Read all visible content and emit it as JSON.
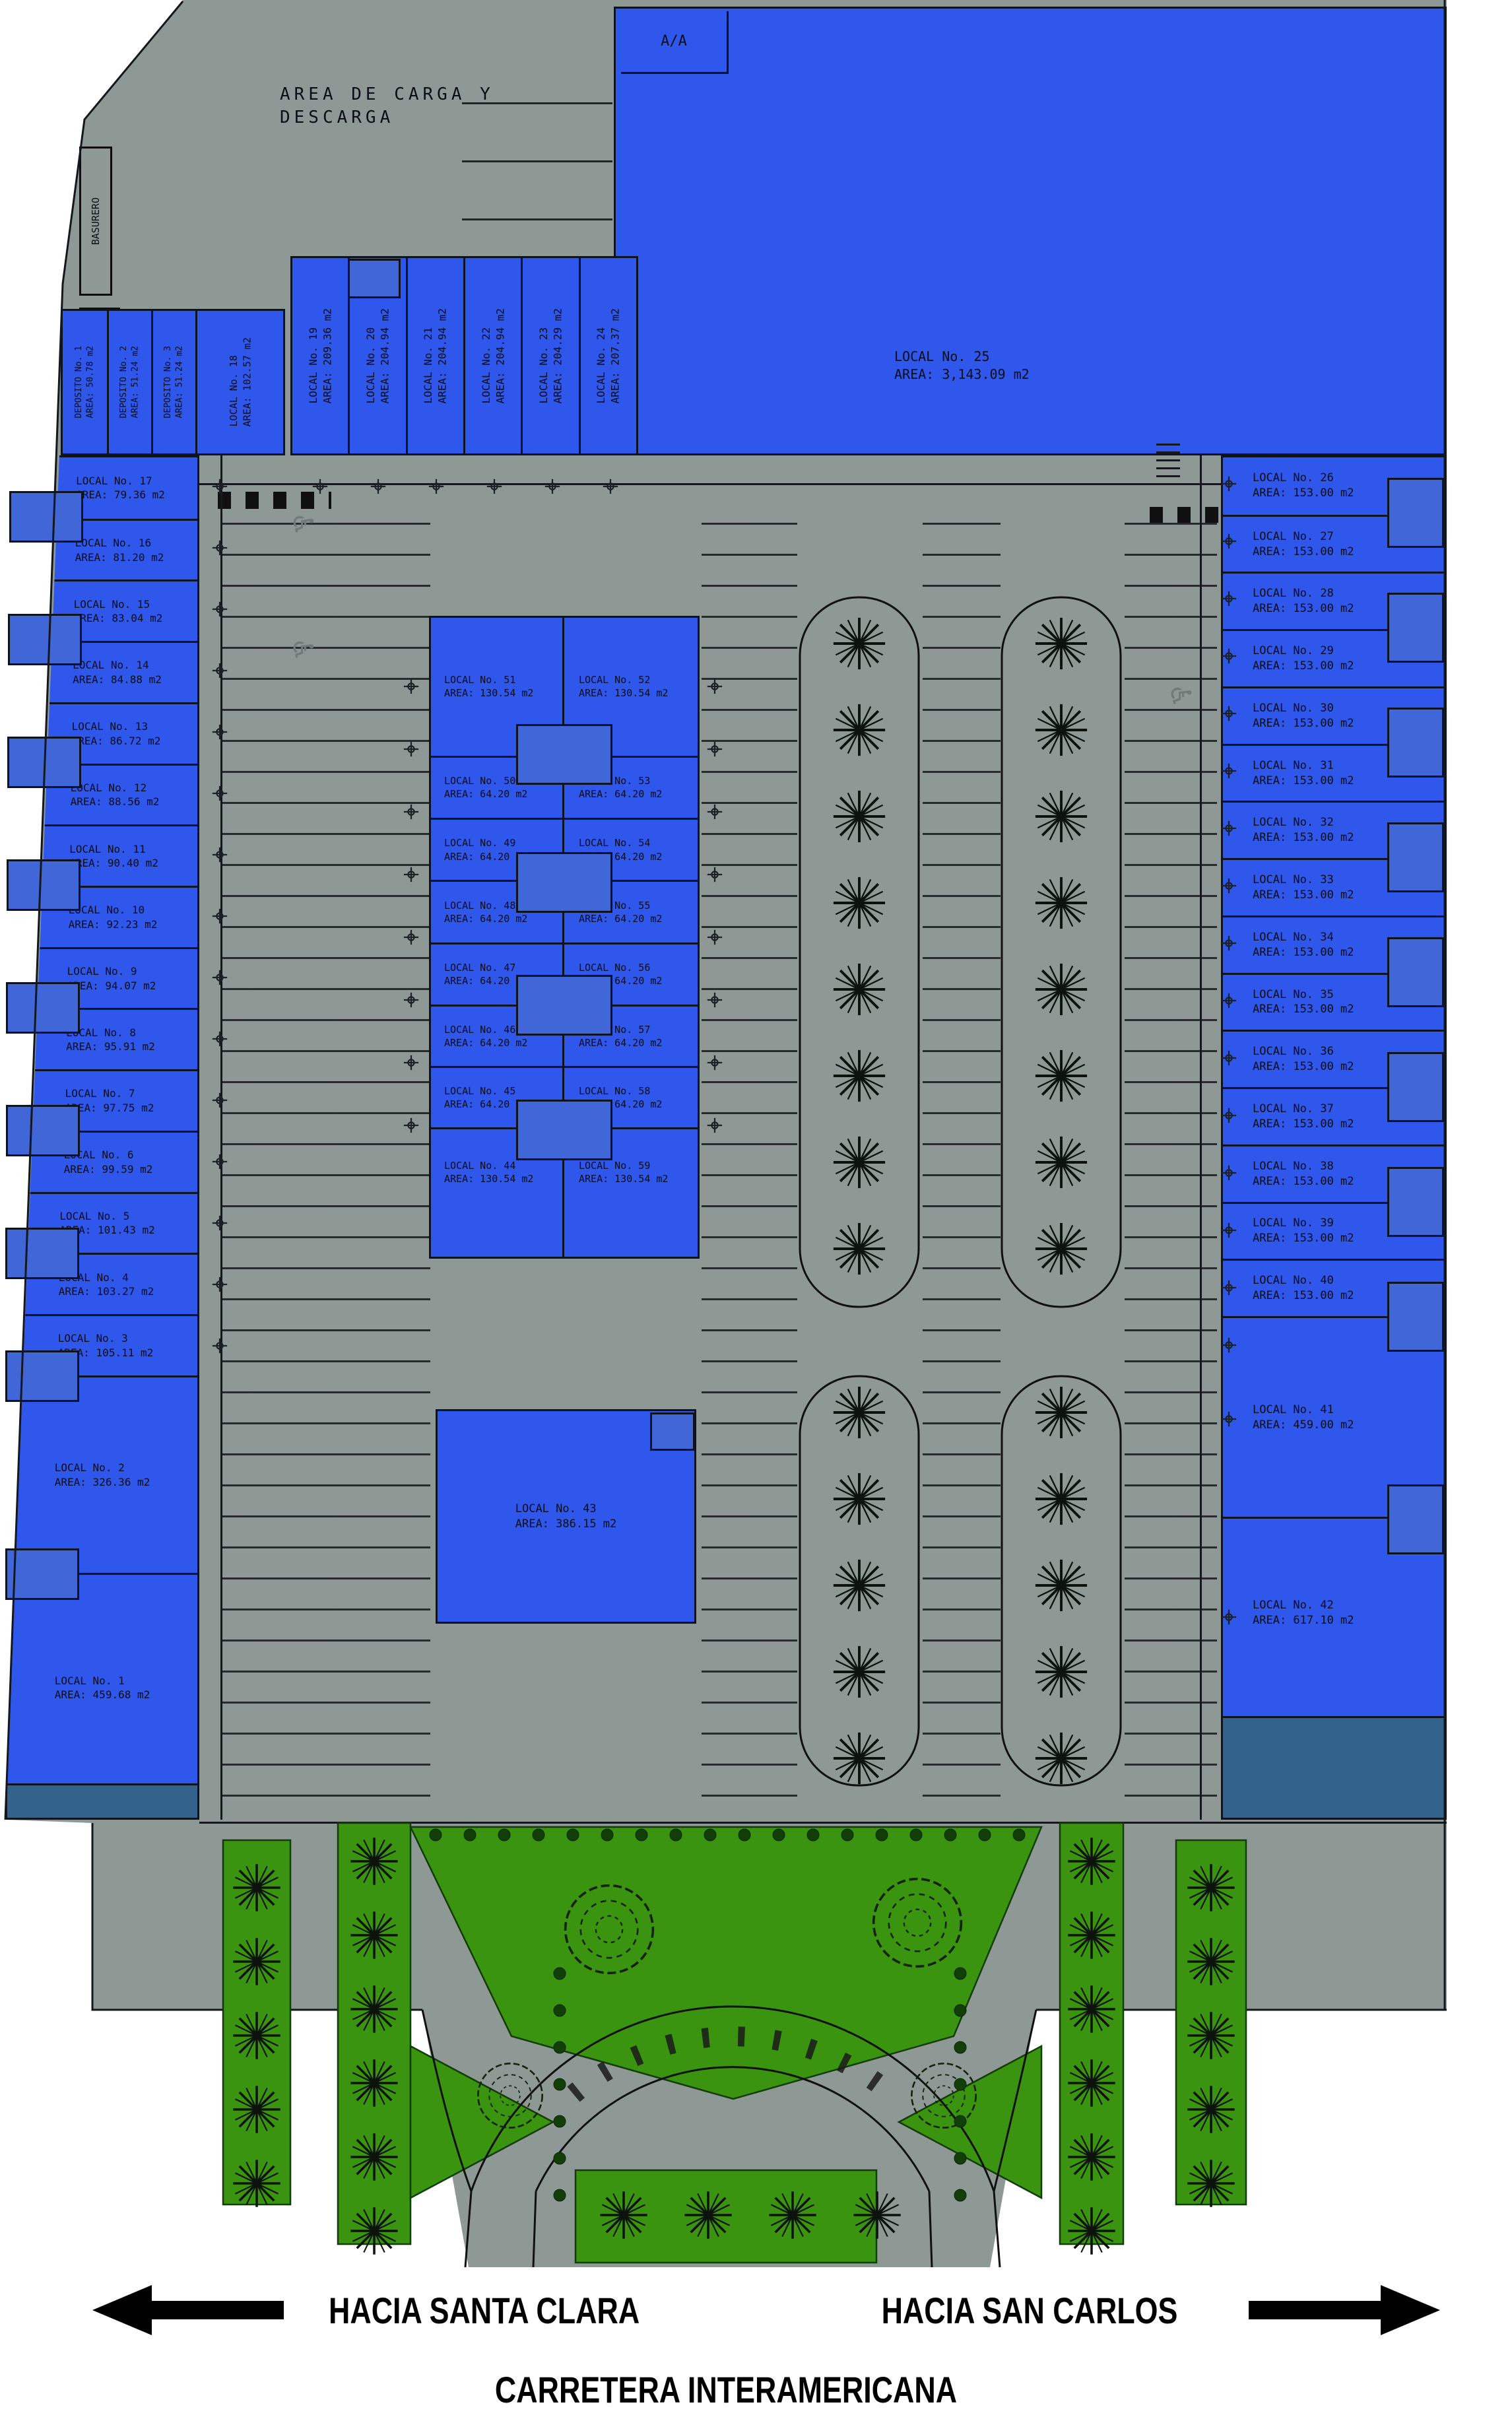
{
  "plan": {
    "carga_label": "AREA DE CARGA Y\nDESCARGA",
    "aa_label": "A/A",
    "basurero_label": "BASURERO",
    "transformer_label": "TX-1 500KVA",
    "bottom": {
      "left_destination": "HACIA SANTA CLARA",
      "right_destination": "HACIA SAN CARLOS",
      "road_name": "CARRETERA INTERAMERICANA"
    },
    "colors": {
      "building_blue": "#2f57ec",
      "awning_blue": "#33628d",
      "site_gray": "#8e9995",
      "landscape_green": "#3a940f"
    }
  },
  "depositos": [
    {
      "name": "DEPOSITO No. 1",
      "area": "AREA: 50.78 m2"
    },
    {
      "name": "DEPOSITO No. 2",
      "area": "AREA: 51.24 m2"
    },
    {
      "name": "DEPOSITO No. 3",
      "area": "AREA: 51.24 m2"
    }
  ],
  "local18": {
    "name": "LOCAL No. 18",
    "area": "AREA: 102.57 m2"
  },
  "top_locals": [
    {
      "name": "LOCAL No. 19",
      "area": "AREA: 209.36 m2"
    },
    {
      "name": "LOCAL No. 20",
      "area": "AREA: 204.94 m2"
    },
    {
      "name": "LOCAL No. 21",
      "area": "AREA: 204.94 m2"
    },
    {
      "name": "LOCAL No. 22",
      "area": "AREA: 204.94 m2"
    },
    {
      "name": "LOCAL No. 23",
      "area": "AREA: 204.29 m2"
    },
    {
      "name": "LOCAL No. 24",
      "area": "AREA: 207.37 m2"
    }
  ],
  "local25": {
    "name": "LOCAL No. 25",
    "area": "AREA: 3,143.09 m2"
  },
  "local43": {
    "name": "LOCAL No. 43",
    "area": "AREA: 386.15 m2"
  },
  "left_locals": [
    {
      "name": "LOCAL No. 17",
      "area": "AREA: 79.36 m2"
    },
    {
      "name": "LOCAL No. 16",
      "area": "AREA: 81.20 m2"
    },
    {
      "name": "LOCAL No. 15",
      "area": "AREA: 83.04 m2"
    },
    {
      "name": "LOCAL No. 14",
      "area": "AREA: 84.88 m2"
    },
    {
      "name": "LOCAL No. 13",
      "area": "AREA: 86.72 m2"
    },
    {
      "name": "LOCAL No. 12",
      "area": "AREA: 88.56 m2"
    },
    {
      "name": "LOCAL No. 11",
      "area": "AREA: 90.40 m2"
    },
    {
      "name": "LOCAL No. 10",
      "area": "AREA: 92.23 m2"
    },
    {
      "name": "LOCAL No. 9",
      "area": "AREA: 94.07 m2"
    },
    {
      "name": "LOCAL No. 8",
      "area": "AREA: 95.91 m2"
    },
    {
      "name": "LOCAL No. 7",
      "area": "AREA: 97.75 m2"
    },
    {
      "name": "LOCAL No. 6",
      "area": "AREA: 99.59 m2"
    },
    {
      "name": "LOCAL No. 5",
      "area": "AREA: 101.43 m2"
    },
    {
      "name": "LOCAL No. 4",
      "area": "AREA: 103.27 m2"
    },
    {
      "name": "LOCAL No. 3",
      "area": "AREA: 105.11 m2"
    },
    {
      "name": "LOCAL No. 2",
      "area": "AREA: 326.36 m2"
    },
    {
      "name": "LOCAL No. 1",
      "area": "AREA: 459.68 m2"
    }
  ],
  "center_west": [
    {
      "name": "LOCAL No. 51",
      "area": "AREA: 130.54 m2"
    },
    {
      "name": "LOCAL No. 50",
      "area": "AREA: 64.20 m2"
    },
    {
      "name": "LOCAL No. 49",
      "area": "AREA: 64.20 m2"
    },
    {
      "name": "LOCAL No. 48",
      "area": "AREA: 64.20 m2"
    },
    {
      "name": "LOCAL No. 47",
      "area": "AREA: 64.20 m2"
    },
    {
      "name": "LOCAL No. 46",
      "area": "AREA: 64.20 m2"
    },
    {
      "name": "LOCAL No. 45",
      "area": "AREA: 64.20 m2"
    },
    {
      "name": "LOCAL No. 44",
      "area": "AREA: 130.54 m2"
    }
  ],
  "center_east": [
    {
      "name": "LOCAL No. 52",
      "area": "AREA: 130.54 m2"
    },
    {
      "name": "LOCAL No. 53",
      "area": "AREA: 64.20 m2"
    },
    {
      "name": "LOCAL No. 54",
      "area": "AREA: 64.20 m2"
    },
    {
      "name": "LOCAL No. 55",
      "area": "AREA: 64.20 m2"
    },
    {
      "name": "LOCAL No. 56",
      "area": "AREA: 64.20 m2"
    },
    {
      "name": "LOCAL No. 57",
      "area": "AREA: 64.20 m2"
    },
    {
      "name": "LOCAL No. 58",
      "area": "AREA: 64.20 m2"
    },
    {
      "name": "LOCAL No. 59",
      "area": "AREA: 130.54 m2"
    }
  ],
  "right_locals": [
    {
      "name": "LOCAL No. 26",
      "area": "AREA: 153.00 m2"
    },
    {
      "name": "LOCAL No. 27",
      "area": "AREA: 153.00 m2"
    },
    {
      "name": "LOCAL No. 28",
      "area": "AREA: 153.00 m2"
    },
    {
      "name": "LOCAL No. 29",
      "area": "AREA: 153.00 m2"
    },
    {
      "name": "LOCAL No. 30",
      "area": "AREA: 153.00 m2"
    },
    {
      "name": "LOCAL No. 31",
      "area": "AREA: 153.00 m2"
    },
    {
      "name": "LOCAL No. 32",
      "area": "AREA: 153.00 m2"
    },
    {
      "name": "LOCAL No. 33",
      "area": "AREA: 153.00 m2"
    },
    {
      "name": "LOCAL No. 34",
      "area": "AREA: 153.00 m2"
    },
    {
      "name": "LOCAL No. 35",
      "area": "AREA: 153.00 m2"
    },
    {
      "name": "LOCAL No. 36",
      "area": "AREA: 153.00 m2"
    },
    {
      "name": "LOCAL No. 37",
      "area": "AREA: 153.00 m2"
    },
    {
      "name": "LOCAL No. 38",
      "area": "AREA: 153.00 m2"
    },
    {
      "name": "LOCAL No. 39",
      "area": "AREA: 153.00 m2"
    },
    {
      "name": "LOCAL No. 40",
      "area": "AREA: 153.00 m2"
    },
    {
      "name": "LOCAL No. 41",
      "area": "AREA: 459.00 m2"
    },
    {
      "name": "LOCAL No. 42",
      "area": "AREA: 617.10 m2"
    }
  ]
}
